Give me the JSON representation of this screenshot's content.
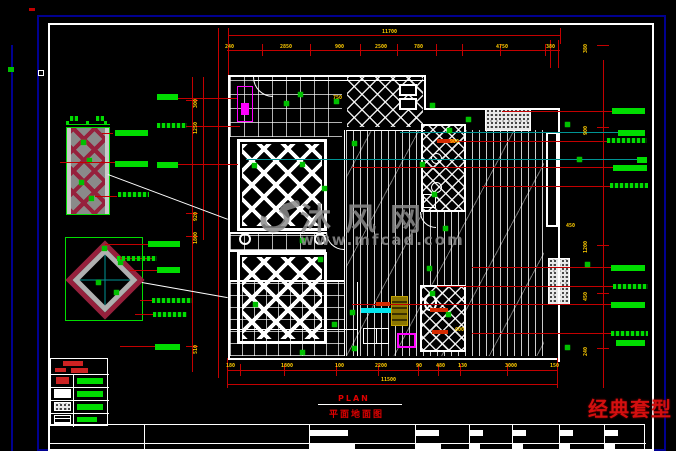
{
  "titles": {
    "plan_en": "PLAN",
    "plan_cn": "平面地面图",
    "style_tag": "经典套型"
  },
  "watermark": {
    "brand": "沐风网",
    "url": "www.mfcad.com",
    "logo": "mf-logo"
  },
  "dimensions": {
    "top_overall": "11700",
    "top": [
      "240",
      "2850",
      "900",
      "2500",
      "780",
      "4750",
      "380"
    ],
    "bottom_overall": "11500",
    "bottom": [
      "180",
      "1800",
      "100",
      "2200",
      "90",
      "480",
      "130",
      "3000",
      "150"
    ],
    "left": [
      "300",
      "1250",
      "920",
      "1800",
      "510"
    ],
    "right": [
      "380",
      "900",
      "1200",
      "450",
      "240"
    ],
    "misc": [
      "750",
      "900",
      "600",
      "450"
    ]
  },
  "colors": {
    "dimension_red": "#c40000",
    "annotation_green": "#00dd00",
    "dimension_text_yellow": "#ffcc00",
    "frame_navy": "#000090",
    "wall_white": "#ffffff",
    "accent_magenta": "#ff00ff",
    "accent_cyan": "#00e5ee",
    "leader_teal": "#009494",
    "title_red": "#e00000",
    "watermark_gray": "#8d8d8d",
    "detail_crimson": "#96203c"
  }
}
